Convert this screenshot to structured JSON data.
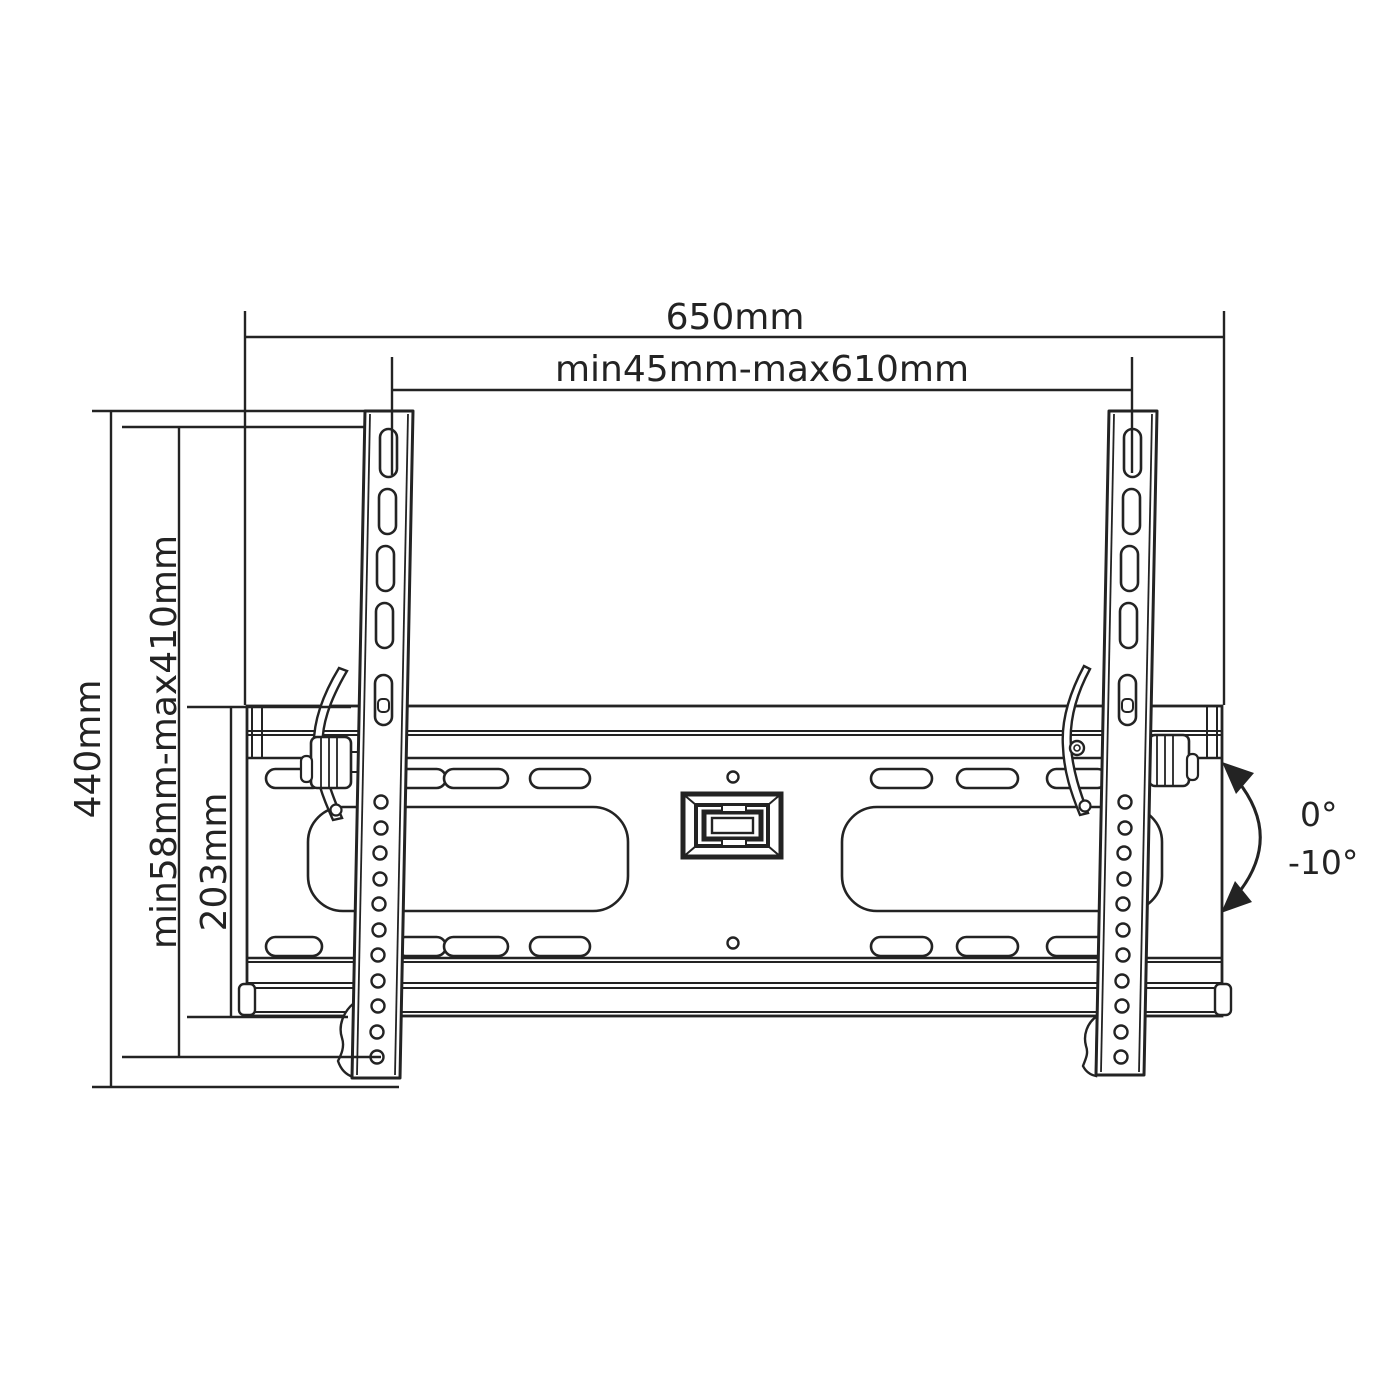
{
  "diagram": {
    "colors": {
      "line": "#232323",
      "background": "#ffffff"
    },
    "dimensions": {
      "total_width": "650mm",
      "vesa_width_range": "min45mm-max610mm",
      "total_height": "440mm",
      "vesa_height_range": "min58mm-max410mm",
      "wall_plate_height": "203mm"
    },
    "tilt": {
      "upper_angle": "0°",
      "lower_angle": "-10°"
    }
  }
}
